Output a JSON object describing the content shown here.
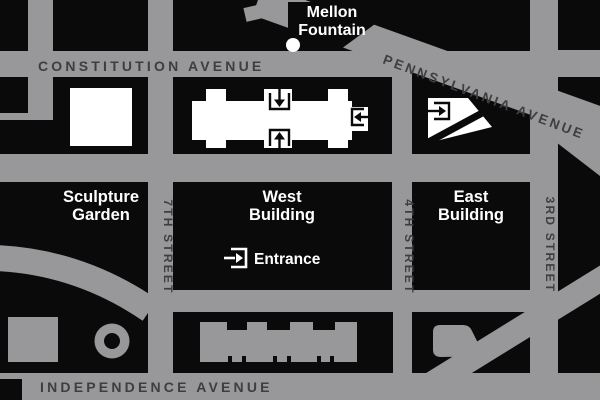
{
  "map": {
    "streets": {
      "constitution": "CONSTITUTION AVENUE",
      "pennsylvania": "PENNSYLVANIA AVENUE",
      "independence": "INDEPENDENCE AVENUE",
      "seventh": "7TH STREET",
      "fourth": "4TH STREET",
      "third": "3RD STREET"
    },
    "landmarks": {
      "mellon_line1": "Mellon",
      "mellon_line2": "Fountain",
      "sculpture_line1": "Sculpture",
      "sculpture_line2": "Garden",
      "west_line1": "West",
      "west_line2": "Building",
      "east_line1": "East",
      "east_line2": "Building",
      "entrance": "Entrance"
    },
    "colors": {
      "street_gray": "#98989a",
      "block_black": "#0a0a0b",
      "street_text": "#3e3e40",
      "label_text": "#ffffff"
    }
  }
}
